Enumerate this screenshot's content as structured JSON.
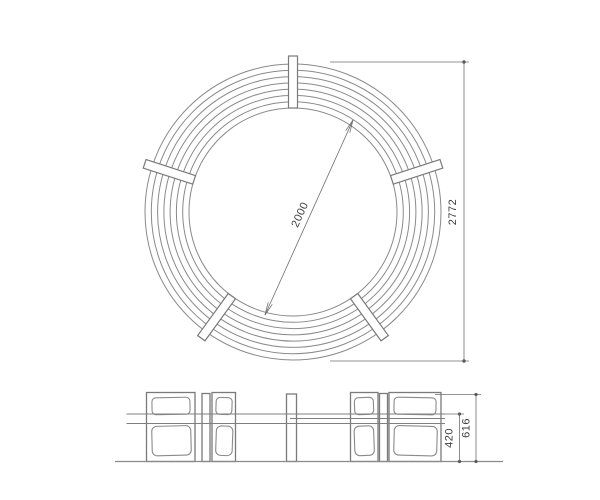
{
  "drawing": {
    "type": "technical-drawing",
    "subject": "circular bench, plan view and front elevation",
    "background_color": "#ffffff",
    "line_color": "#7a7a7a",
    "dimension_line_color": "#6f6f6f",
    "text_color": "#3d3d3d",
    "plan": {
      "inner_diameter": "2000",
      "outer_diameter": "2772",
      "slat_circle_count": 8,
      "batten_count": 5
    },
    "elevation": {
      "seat_height": "420",
      "overall_height": "616"
    }
  }
}
